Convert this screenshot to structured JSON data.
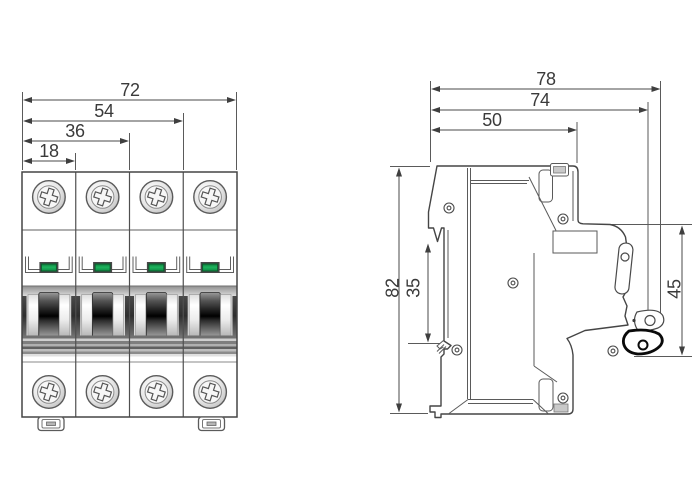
{
  "drawing": {
    "type": "technical-dimension-drawing",
    "subject": "4-pole miniature circuit breaker (MCB) outline drawing, front and side views",
    "poles": 4
  },
  "front_view": {
    "name": "front view",
    "dim_total_width": "72",
    "dim_three_pole": "54",
    "dim_two_pole": "36",
    "dim_one_pole": "18"
  },
  "side_view": {
    "name": "side view",
    "dim_depth_overall": "78",
    "dim_depth_body": "74",
    "dim_depth_top": "50",
    "dim_height": "82",
    "dim_din_rail": "35",
    "dim_front_height": "45"
  },
  "colors": {
    "line": "#4a4a4a",
    "text": "#3a3a3a",
    "indicator_green": "#16a24f",
    "indicator_green_dark": "#0a5c2d",
    "handle_black": "#0a0a0a"
  }
}
